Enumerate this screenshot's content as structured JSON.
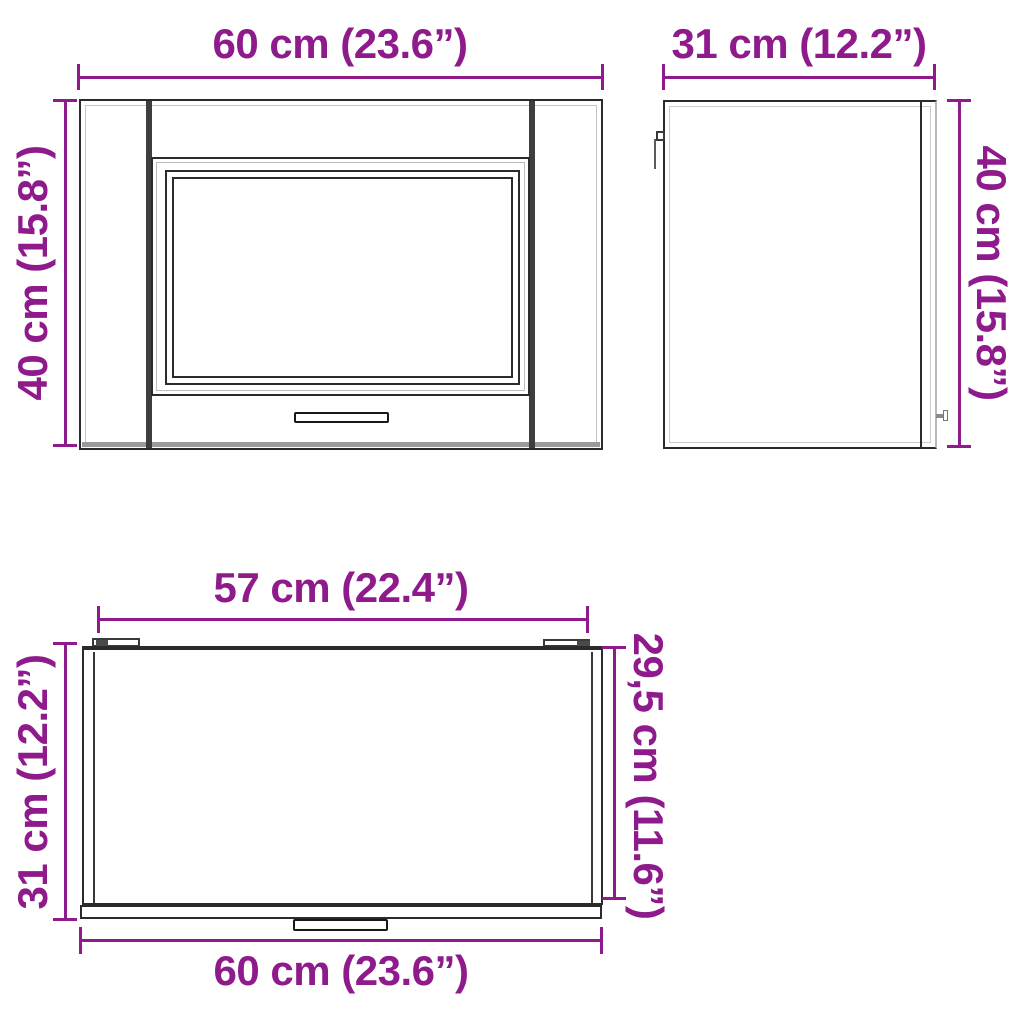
{
  "colors": {
    "dimension": "#8e1a8c",
    "outline": "#2b2b2b",
    "stile": "#3e3e3e",
    "soft_gray": "#9b9b9b"
  },
  "views": {
    "front": {
      "width_label": "60 cm (23.6”)",
      "height_label": "40 cm (15.8”)"
    },
    "side": {
      "depth_label": "31 cm (12.2”)",
      "height_label": "40 cm (15.8”)"
    },
    "top": {
      "hinge_span_label": "57 cm (22.4”)",
      "total_depth_label": "31 cm (12.2”)",
      "body_depth_label": "29,5 cm (11.6”)",
      "width_label": "60 cm (23.6”)"
    }
  }
}
